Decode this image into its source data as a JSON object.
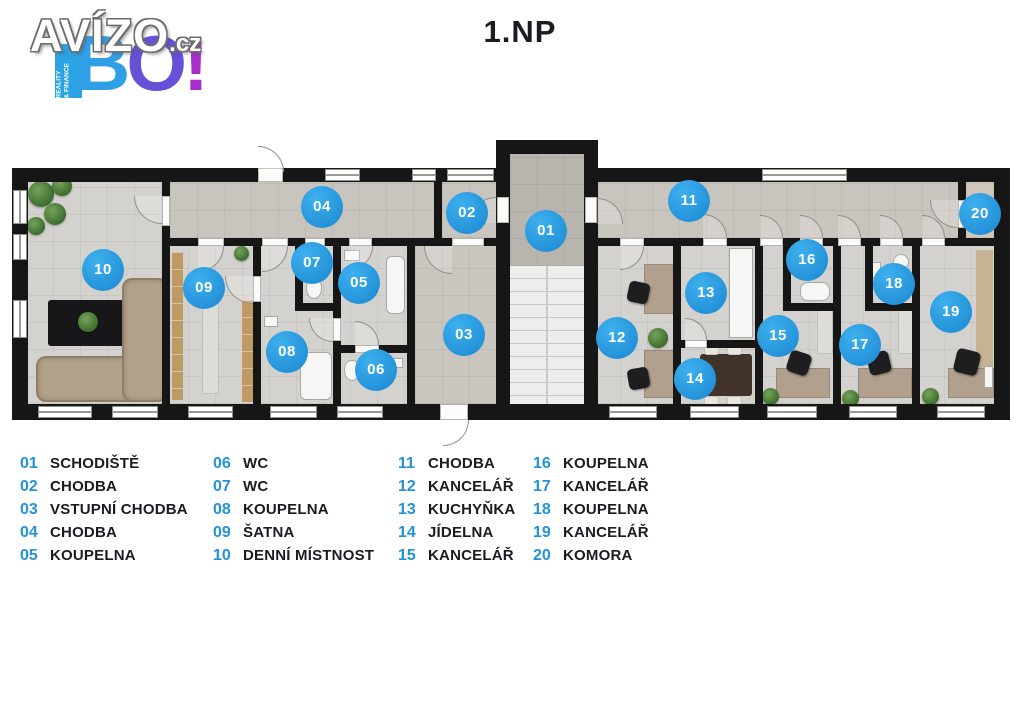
{
  "title": "1.NP",
  "logo": {
    "brand": "AVÍZO",
    "domain": ".cz",
    "bang": "BO!",
    "ribbon_line1": "REALITY",
    "ribbon_line2": "& FINANCE"
  },
  "colors": {
    "marker_blue": "#2492d9",
    "legend_number_blue": "#2d9de2",
    "text_dark": "#1b1c22",
    "wall": "#161616",
    "floor_room": "#d4d2ce",
    "floor_corridor": "#c8c4be",
    "logo_blue": "#2fa0e8",
    "logo_purple": "#a82ecb"
  },
  "floorplan": {
    "markers": [
      {
        "num": "01",
        "x": 546,
        "y": 231
      },
      {
        "num": "02",
        "x": 467,
        "y": 213
      },
      {
        "num": "03",
        "x": 464,
        "y": 335
      },
      {
        "num": "04",
        "x": 322,
        "y": 207
      },
      {
        "num": "05",
        "x": 359,
        "y": 283
      },
      {
        "num": "06",
        "x": 376,
        "y": 370
      },
      {
        "num": "07",
        "x": 312,
        "y": 263
      },
      {
        "num": "08",
        "x": 287,
        "y": 352
      },
      {
        "num": "09",
        "x": 204,
        "y": 288
      },
      {
        "num": "10",
        "x": 103,
        "y": 270
      },
      {
        "num": "11",
        "x": 689,
        "y": 201
      },
      {
        "num": "12",
        "x": 617,
        "y": 338
      },
      {
        "num": "13",
        "x": 706,
        "y": 293
      },
      {
        "num": "14",
        "x": 695,
        "y": 379
      },
      {
        "num": "15",
        "x": 778,
        "y": 336
      },
      {
        "num": "16",
        "x": 807,
        "y": 260
      },
      {
        "num": "17",
        "x": 860,
        "y": 345
      },
      {
        "num": "18",
        "x": 894,
        "y": 284
      },
      {
        "num": "19",
        "x": 951,
        "y": 312
      },
      {
        "num": "20",
        "x": 980,
        "y": 214
      }
    ]
  },
  "legend": {
    "columns": [
      [
        {
          "num": "01",
          "label": "SCHODIŠTĚ"
        },
        {
          "num": "02",
          "label": "CHODBA"
        },
        {
          "num": "03",
          "label": "VSTUPNÍ CHODBA"
        },
        {
          "num": "04",
          "label": "CHODBA"
        },
        {
          "num": "05",
          "label": "KOUPELNA"
        }
      ],
      [
        {
          "num": "06",
          "label": "WC"
        },
        {
          "num": "07",
          "label": "WC"
        },
        {
          "num": "08",
          "label": "KOUPELNA"
        },
        {
          "num": "09",
          "label": "ŠATNA"
        },
        {
          "num": "10",
          "label": "DENNÍ MÍSTNOST"
        }
      ],
      [
        {
          "num": "11",
          "label": "CHODBA"
        },
        {
          "num": "12",
          "label": "KANCELÁŘ"
        },
        {
          "num": "13",
          "label": "KUCHYŇKA"
        },
        {
          "num": "14",
          "label": "JÍDELNA"
        },
        {
          "num": "15",
          "label": "KANCELÁŘ"
        }
      ],
      [
        {
          "num": "16",
          "label": "KOUPELNA"
        },
        {
          "num": "17",
          "label": "KANCELÁŘ"
        },
        {
          "num": "18",
          "label": "KOUPELNA"
        },
        {
          "num": "19",
          "label": "KANCELÁŘ"
        },
        {
          "num": "20",
          "label": "KOMORA"
        }
      ]
    ]
  }
}
